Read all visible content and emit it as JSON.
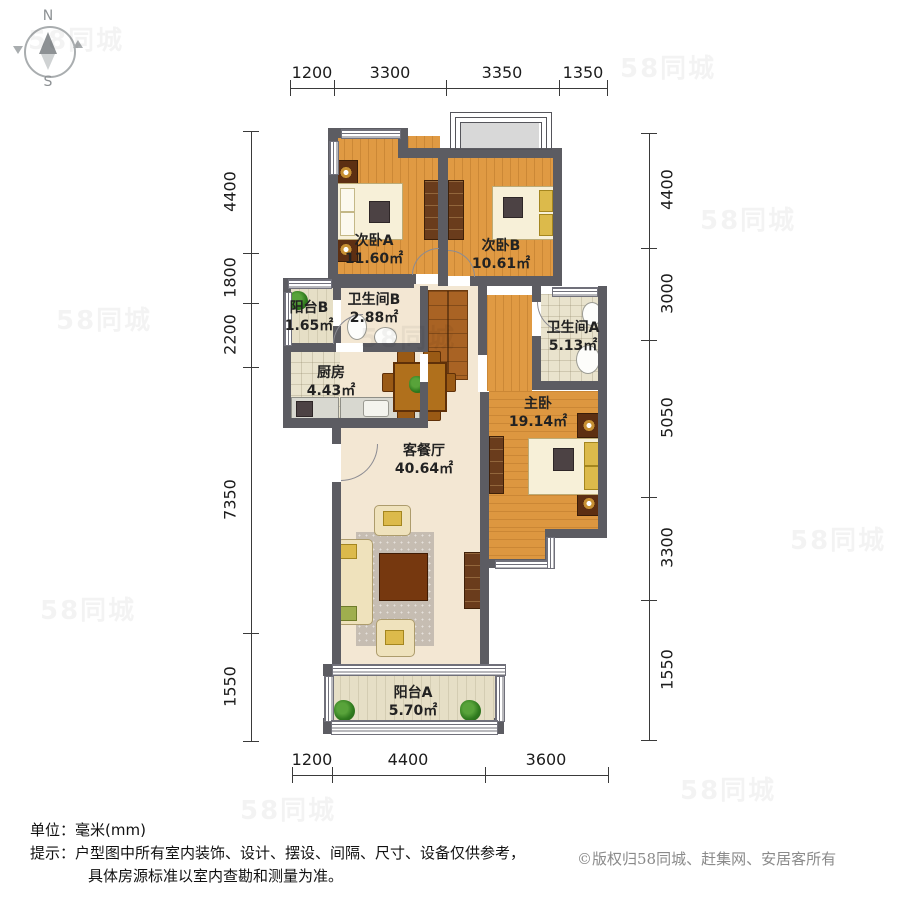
{
  "compass": {
    "north": "N",
    "south": "S"
  },
  "rooms": [
    {
      "name": "次卧A",
      "area": "11.60㎡"
    },
    {
      "name": "次卧B",
      "area": "10.61㎡"
    },
    {
      "name": "阳台B",
      "area": "1.65㎡"
    },
    {
      "name": "卫生间B",
      "area": "2.88㎡"
    },
    {
      "name": "厨房",
      "area": "4.43㎡"
    },
    {
      "name": "卫生间A",
      "area": "5.13㎡"
    },
    {
      "name": "主卧",
      "area": "19.14㎡"
    },
    {
      "name": "客餐厅",
      "area": "40.64㎡"
    },
    {
      "name": "阳台A",
      "area": "5.70㎡"
    }
  ],
  "dimensions": {
    "top": [
      "1200",
      "3300",
      "3350",
      "1350"
    ],
    "bottom": [
      "1200",
      "4400",
      "3600"
    ],
    "left": [
      "4400",
      "1800",
      "2200",
      "7350",
      "1550"
    ],
    "right": [
      "4400",
      "3000",
      "5050",
      "3300",
      "1550"
    ]
  },
  "footer": {
    "unit": "单位：毫米(mm)",
    "tip1": "提示：户型图中所有室内装饰、设计、摆设、间隔、尺寸、设备仅供参考，",
    "tip2": "具体房源标准以室内查勘和测量为准。",
    "copyright": "©版权归58同城、赶集网、安居客所有"
  },
  "watermark": "58同城",
  "colors": {
    "wall": "#5c5c62",
    "wood_floor": "#e09a43",
    "living_floor": "#f3e7d3",
    "tile_floor": "#e9e3cd"
  }
}
